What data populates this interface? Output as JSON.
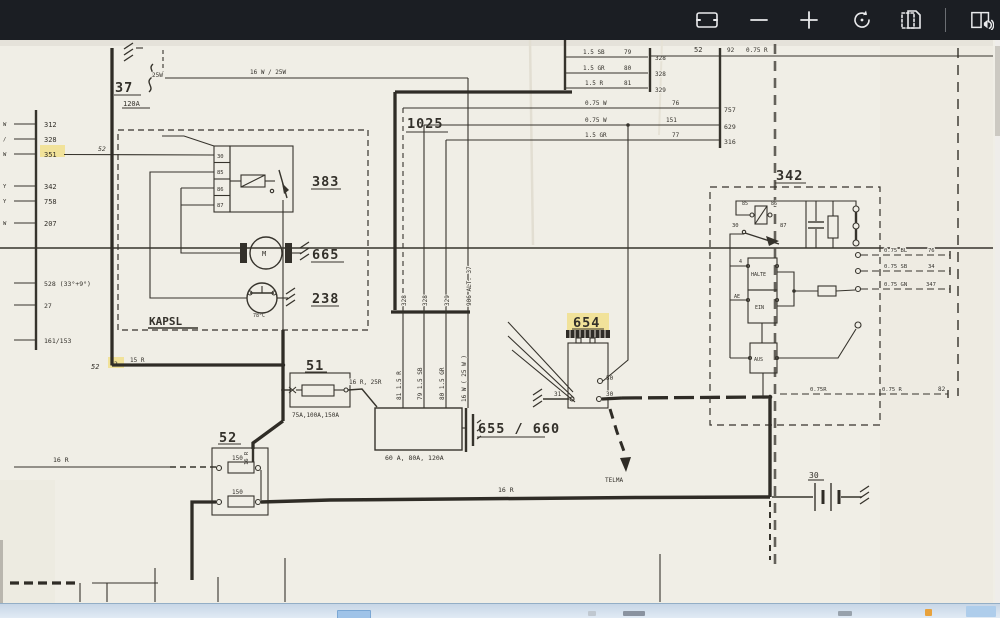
{
  "toolbar": {
    "icons": [
      {
        "name": "fit-to-window"
      },
      {
        "name": "zoom-out"
      },
      {
        "name": "zoom-in"
      },
      {
        "name": "rotate"
      },
      {
        "name": "crop"
      },
      {
        "name": "read-aloud"
      }
    ]
  },
  "colors": {
    "toolbar_bg": "#1b1e23",
    "paper": "#f0eee6",
    "ink": "#36332c",
    "highlight": "#f2da6a"
  },
  "schematic": {
    "fuse37": {
      "label": "37",
      "rating": "25W",
      "amps": "120A"
    },
    "wire_16w": "16 W / 25W",
    "box1025": {
      "label": "1025"
    },
    "left_bus": {
      "letters": [
        "W",
        "/",
        "W",
        "Y",
        "Y",
        "W"
      ],
      "nums": [
        "312",
        "328",
        "351",
        "342",
        "758",
        "207"
      ],
      "nums_lower": [
        "528 (33°+9°)",
        "27",
        "161/153"
      ],
      "tap": "52"
    },
    "kapsl": {
      "title": "KAPSL",
      "relay_terms": [
        "30",
        "85",
        "86",
        "87"
      ],
      "relay_id": "383",
      "motor_id": "665",
      "motor_letter": "M",
      "thermo_id": "238",
      "thermo_temp": "78°C"
    },
    "junction": {
      "left": "52",
      "mid": "82",
      "wire": "15 R"
    },
    "fuse51": {
      "label": "51",
      "ratings": "75A,100A,150A",
      "wire": "16 R, 25R"
    },
    "fuse52": {
      "label": "52",
      "f1": "150",
      "f2": "150",
      "wire_in": "16 R",
      "wire_top": "16 R"
    },
    "alt": {
      "label": "655 / 660",
      "ratings": "60 A, 80A, 120A",
      "bundle_tops": [
        "328",
        "328",
        "329",
        "906 ALT. 37"
      ],
      "bundle_mids": [
        "81  1.5 R",
        "79  1.5 SB",
        "80  1.5 GR",
        "16 W ( 25 W )"
      ]
    },
    "tr_rows": [
      {
        "size": "1.5 SB",
        "t": "79",
        "c": "328"
      },
      {
        "size": "1.5 GR",
        "t": "80",
        "c": "328"
      },
      {
        "size": "1.5 R",
        "t": "81",
        "c": "329"
      }
    ],
    "tr_line": {
      "a": "52",
      "b": "92",
      "c": "0.75 R"
    },
    "mid_rows": [
      {
        "size": "0.75 W",
        "t": "76",
        "c": "757"
      },
      {
        "size": "0.75 W",
        "t": "151",
        "c": "629"
      },
      {
        "size": "1.5 GR",
        "t": "77",
        "c": "316"
      }
    ],
    "relay654": {
      "label": "654",
      "t50": "50",
      "t30": "30",
      "t31": "31",
      "arrow": "TELMA"
    },
    "box342": {
      "label": "342",
      "relay": [
        "85",
        "86",
        "30",
        "87"
      ],
      "sw": [
        "HALTE",
        "EIN",
        "AUS"
      ],
      "terms": [
        "4",
        "AE"
      ],
      "out_rows": [
        {
          "size": "0.75 BL",
          "t": "76"
        },
        {
          "size": "0.75 SB",
          "t": "34"
        },
        {
          "size": "0.75 GN",
          "t": "347"
        }
      ],
      "bottom": {
        "w1": "0.75R",
        "w2": "0.75 R",
        "t": "82"
      }
    },
    "battery": {
      "label": "30"
    },
    "main_wire": "16 R",
    "left_lower_wire": "16 R"
  }
}
